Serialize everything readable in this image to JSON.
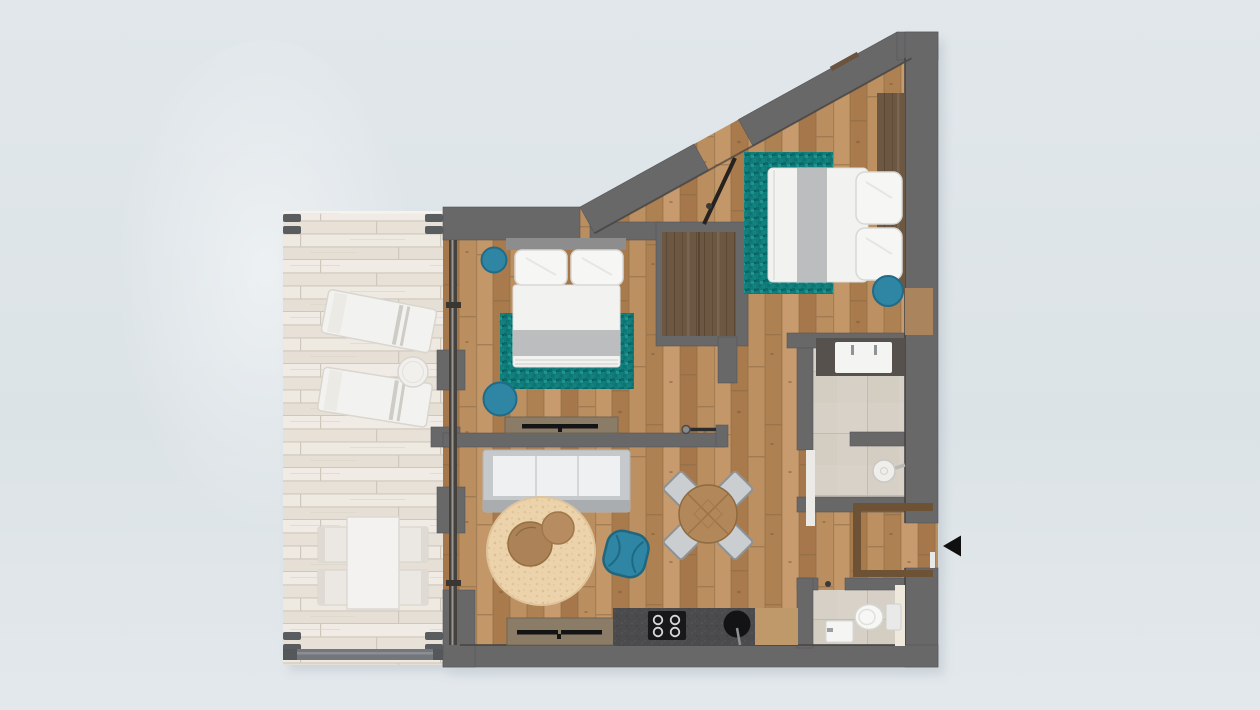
{
  "scene": {
    "description": "Top-down 3D rendered floor plan of a one-bedroom-plus apartment with large terrace",
    "view": "top-down",
    "has_text": false
  },
  "colors": {
    "background": "#dfe5e9",
    "wall": "#686868",
    "wall_dark_edge": "#4c4b4a",
    "wood_floor": "#b68a5c",
    "terrace_wood": "#ece7df",
    "tile": "#d6d0c6",
    "rug_teal": "#117d7b",
    "seat_teal": "#2e86a4",
    "rug_beige": "#ecd3ac",
    "furniture_white": "#f2f2f0",
    "runner_gray": "#bcbdbe",
    "dark_wood": "#6b5742",
    "mid_wood": "#a9845c",
    "console_wood": "#8b7c67",
    "counter_dark": "#4b4b4d",
    "appliance_black": "#18181a",
    "entry_arrow": "#101010",
    "sofa_frame": "#c6c9cc",
    "chair_gray": "#caced1"
  },
  "rooms": [
    {
      "name": "terrace",
      "floor": "whitewashed-wood-planks",
      "items": [
        "sun-lounger",
        "sun-lounger",
        "round-side-table",
        "outdoor-dining-table",
        "outdoor-chair",
        "outdoor-chair",
        "outdoor-chair",
        "outdoor-chair",
        "railing"
      ]
    },
    {
      "name": "bedroom-1",
      "floor": "wood",
      "items": [
        "double-bed",
        "pillows",
        "teal-rug",
        "teal-pouf-small",
        "teal-pouf-large",
        "tv-console",
        "headboard"
      ]
    },
    {
      "name": "bedroom-2",
      "floor": "wood",
      "items": [
        "double-bed",
        "pillows",
        "teal-rug",
        "teal-pouf",
        "wardrobe",
        "headboard-panel",
        "open-door"
      ]
    },
    {
      "name": "living-room",
      "floor": "wood",
      "items": [
        "sofa",
        "round-beige-rug",
        "coffee-table",
        "coffee-table",
        "teal-armchair",
        "round-dining-table",
        "dining-chair",
        "dining-chair",
        "dining-chair",
        "dining-chair",
        "tv-console"
      ]
    },
    {
      "name": "kitchen",
      "floor": "wood",
      "items": [
        "counter",
        "cooktop-4-burners",
        "round-sink"
      ]
    },
    {
      "name": "bathroom",
      "floor": "tile",
      "items": [
        "double-vanity",
        "shower",
        "glass-partition",
        "door"
      ]
    },
    {
      "name": "wc",
      "floor": "tile",
      "items": [
        "toilet",
        "washbasin",
        "tall-panel",
        "door-handle"
      ]
    },
    {
      "name": "entry-hall",
      "floor": "wood",
      "items": [
        "entry-door-opening",
        "closet-outline"
      ]
    }
  ],
  "entry": {
    "arrow_glyph": "left-pointing-triangle",
    "side": "right-wall"
  }
}
